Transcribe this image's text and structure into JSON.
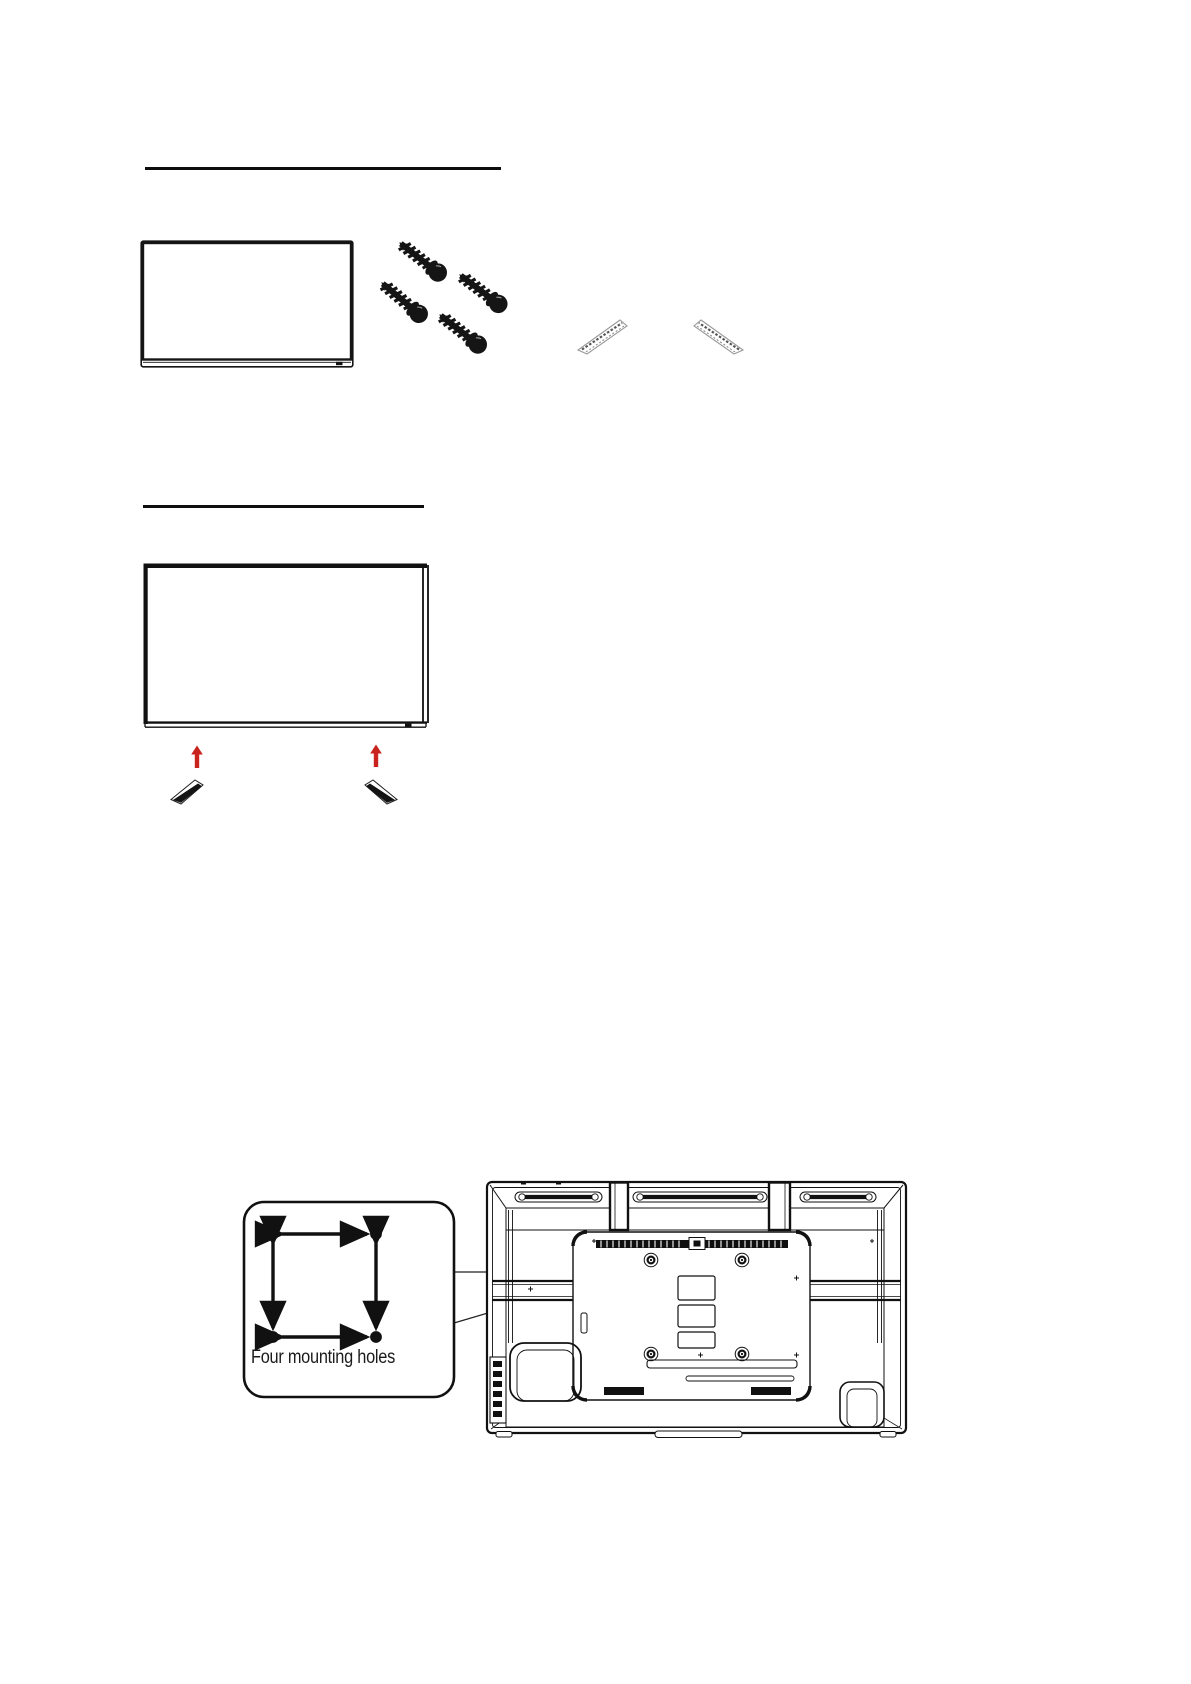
{
  "document": {
    "kind": "tv-stand-and-wall-mount-instructions",
    "figure1": {
      "description": "tv-front-with-screws-and-feet",
      "screw_count": 4,
      "foot_count": 2
    },
    "figure2": {
      "description": "tv-front-with-arrows-to-feet",
      "arrow_count": 2,
      "foot_count": 2
    },
    "figure3": {
      "callout_label": "Four mounting holes",
      "mounting_hole_count": 4
    },
    "colors": {
      "ink": "#111111",
      "arrow_red": "#c8231d",
      "foot_outline": "#999999",
      "label_text": "#1b1b1b",
      "background": "#ffffff"
    }
  }
}
